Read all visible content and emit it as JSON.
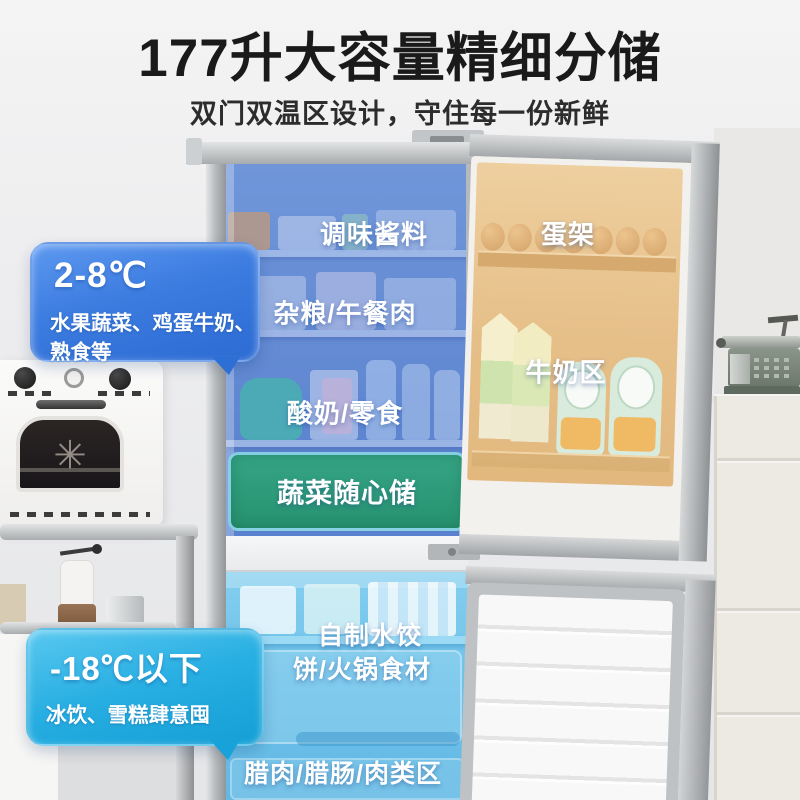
{
  "page": {
    "title": "177升大容量精细分储",
    "subtitle": "双门双温区设计，守住每一份新鲜"
  },
  "fridge_callout": {
    "temp": "2-8℃",
    "line1": "水果蔬菜、鸡蛋牛奶、",
    "line2": "熟食等"
  },
  "freezer_callout": {
    "temp": "-18℃以下",
    "line1": "冰饮、雪糕肆意囤"
  },
  "zones": {
    "condiments": "调味酱料",
    "egg_rack": "蛋架",
    "grains_lunchmeat": "杂粮/午餐肉",
    "milk_zone": "牛奶区",
    "yogurt_snacks": "酸奶/零食",
    "veg_storage": "蔬菜随心储",
    "dumplings": "自制水饺",
    "hotpot": "饼/火锅食材",
    "cured_meat": "腊肉/腊肠/肉类区"
  },
  "colors": {
    "fridge_zone_blue": "#3c7ce0",
    "freezer_zone_cyan": "#27aee2",
    "veg_box_green": "#2a9878",
    "door_zone_orange": "#e8c18a",
    "title_text": "#1a1a1a",
    "label_text": "#ffffff"
  }
}
